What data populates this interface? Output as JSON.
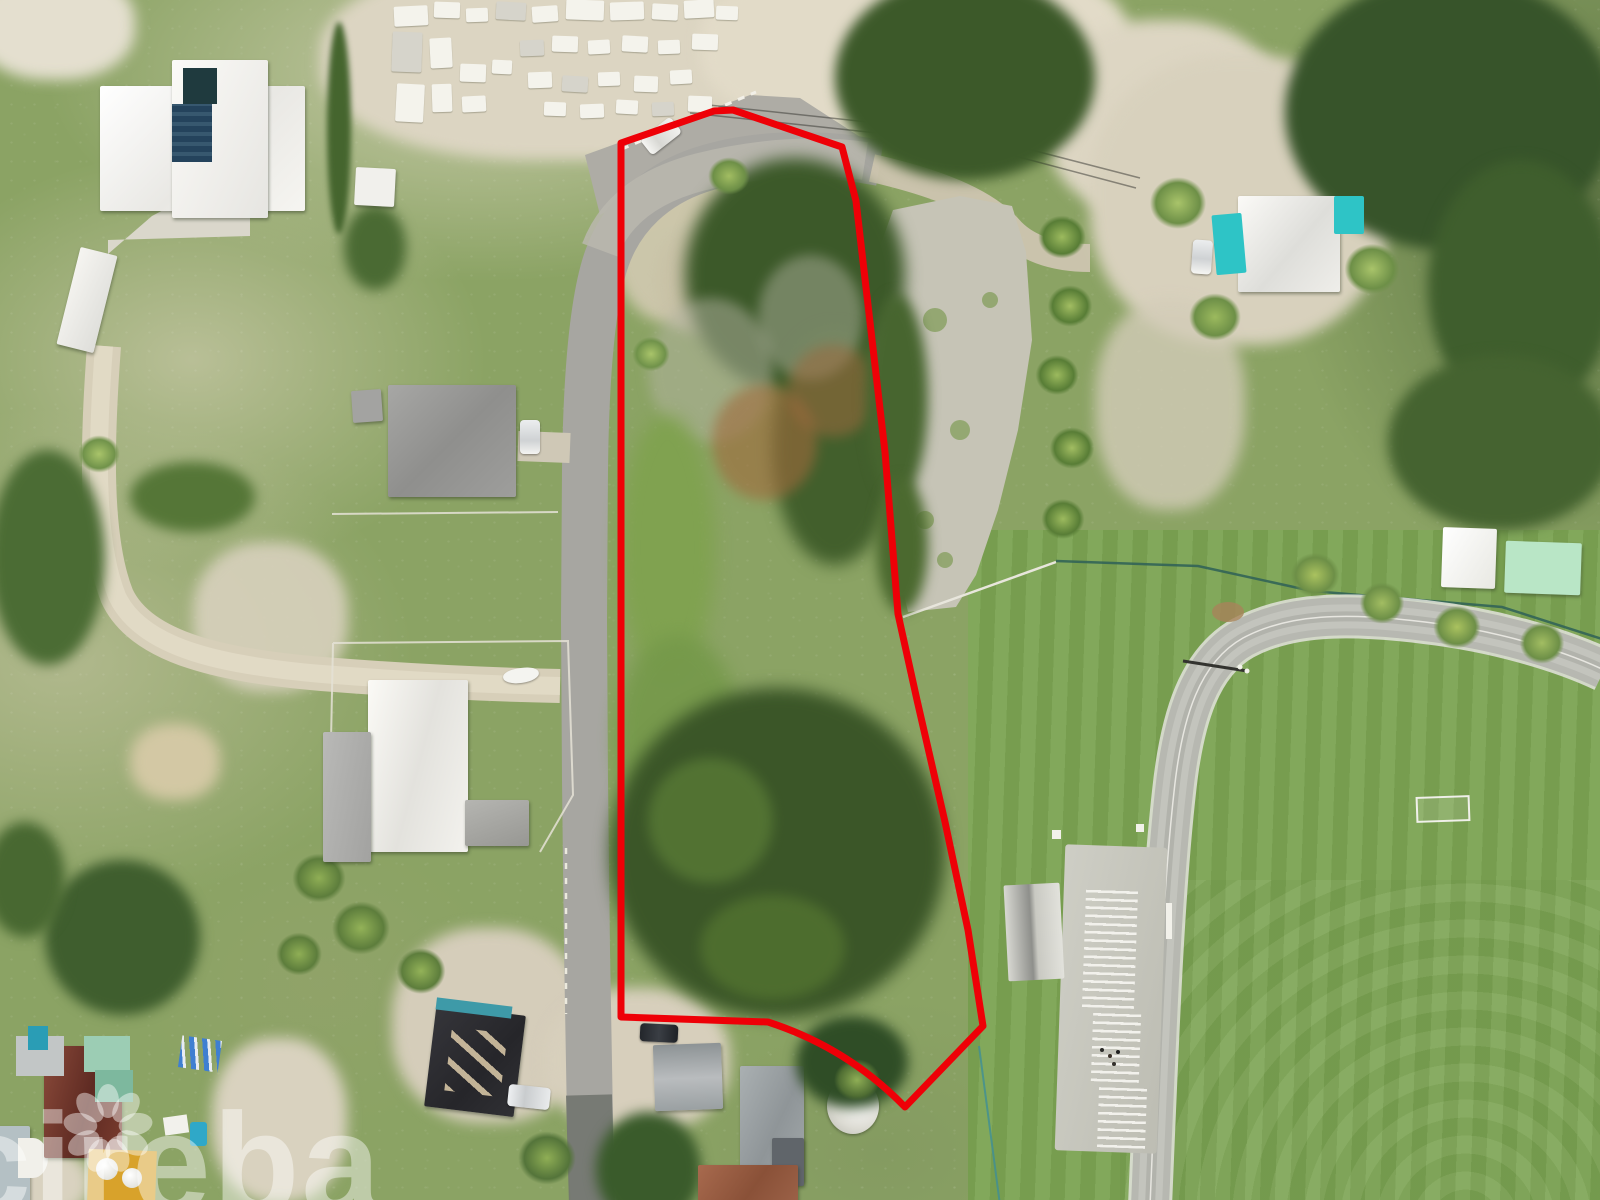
{
  "image": {
    "width": 1600,
    "height": 1200,
    "description": "Aerial drone photo of a vacant treed land parcel outlined in red, between a curving coastal road with a cemetery, residential houses with white and grey roofs, a gravel lot with palms, and a sports field with running track and bleachers"
  },
  "watermark": {
    "text": "cireba",
    "icon": "flower-logo-icon",
    "color": "rgba(255,255,255,0.44)"
  },
  "property_outline": {
    "color": "#ee0007",
    "stroke_width": 7,
    "points": [
      [
        621,
        143
      ],
      [
        714,
        111
      ],
      [
        733,
        110
      ],
      [
        842,
        147
      ],
      [
        856,
        201
      ],
      [
        885,
        452
      ],
      [
        898,
        614
      ],
      [
        917,
        700
      ],
      [
        945,
        822
      ],
      [
        968,
        930
      ],
      [
        983,
        1026
      ],
      [
        905,
        1107
      ]
    ],
    "tip_curve_control": [
      848,
      1048
    ],
    "after_tip": [
      [
        768,
        1022
      ],
      [
        621,
        1017
      ]
    ]
  },
  "palette": {
    "grass": "#8ba364",
    "field_green": "#7ba352",
    "sand": "#d9d2bf",
    "road_gray": "#a7a6a1",
    "track_gray": "#b7b8b1",
    "dark_trees": "#3c5929",
    "outline_red": "#ee0007"
  }
}
